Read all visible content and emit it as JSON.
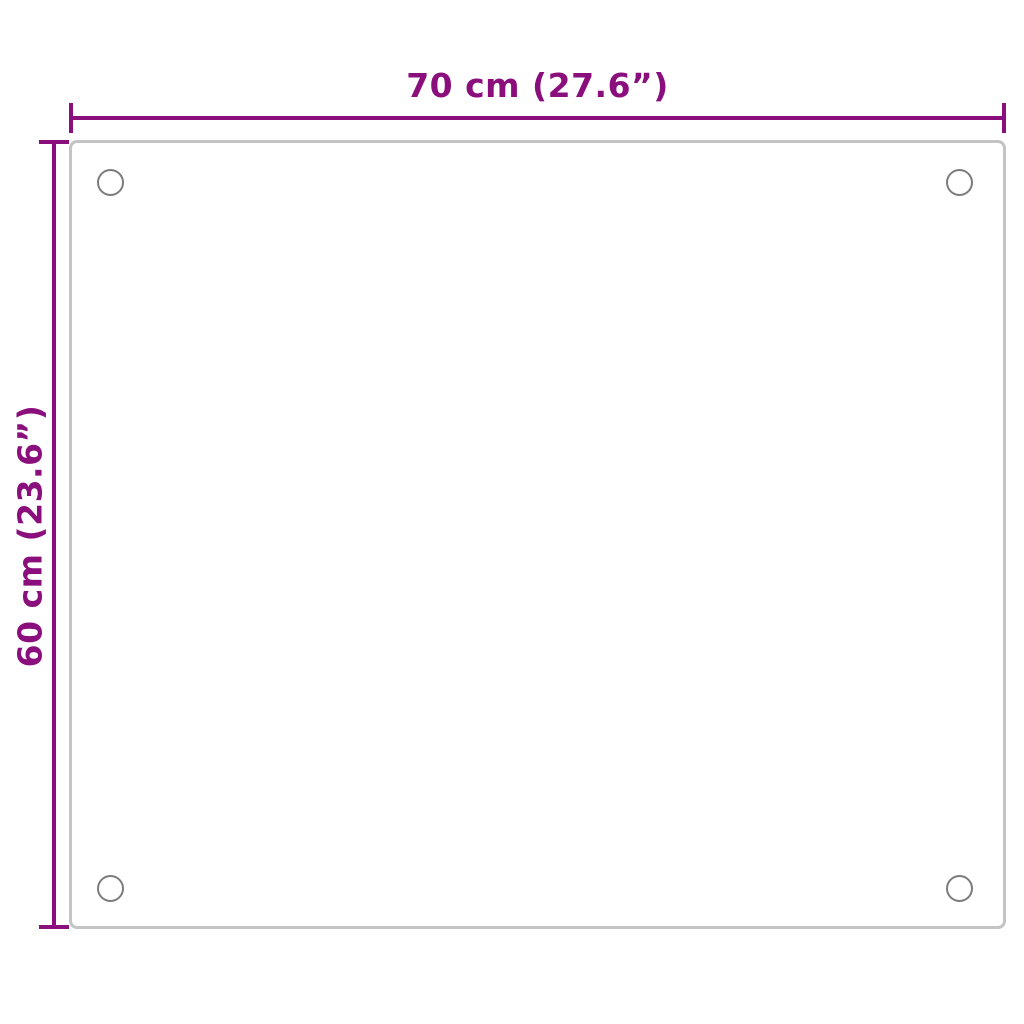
{
  "diagram": {
    "width_dimension": {
      "label": "70 cm (27.6”)"
    },
    "height_dimension": {
      "label": "60 cm (23.6”)"
    },
    "mounting_holes": [
      "top-left",
      "top-right",
      "bottom-left",
      "bottom-right"
    ],
    "colors": {
      "dimension": "#8A0E7C",
      "panel_border": "#C4C4C4",
      "hole_outline": "#7C7C7C",
      "background": "#FFFFFF"
    }
  }
}
